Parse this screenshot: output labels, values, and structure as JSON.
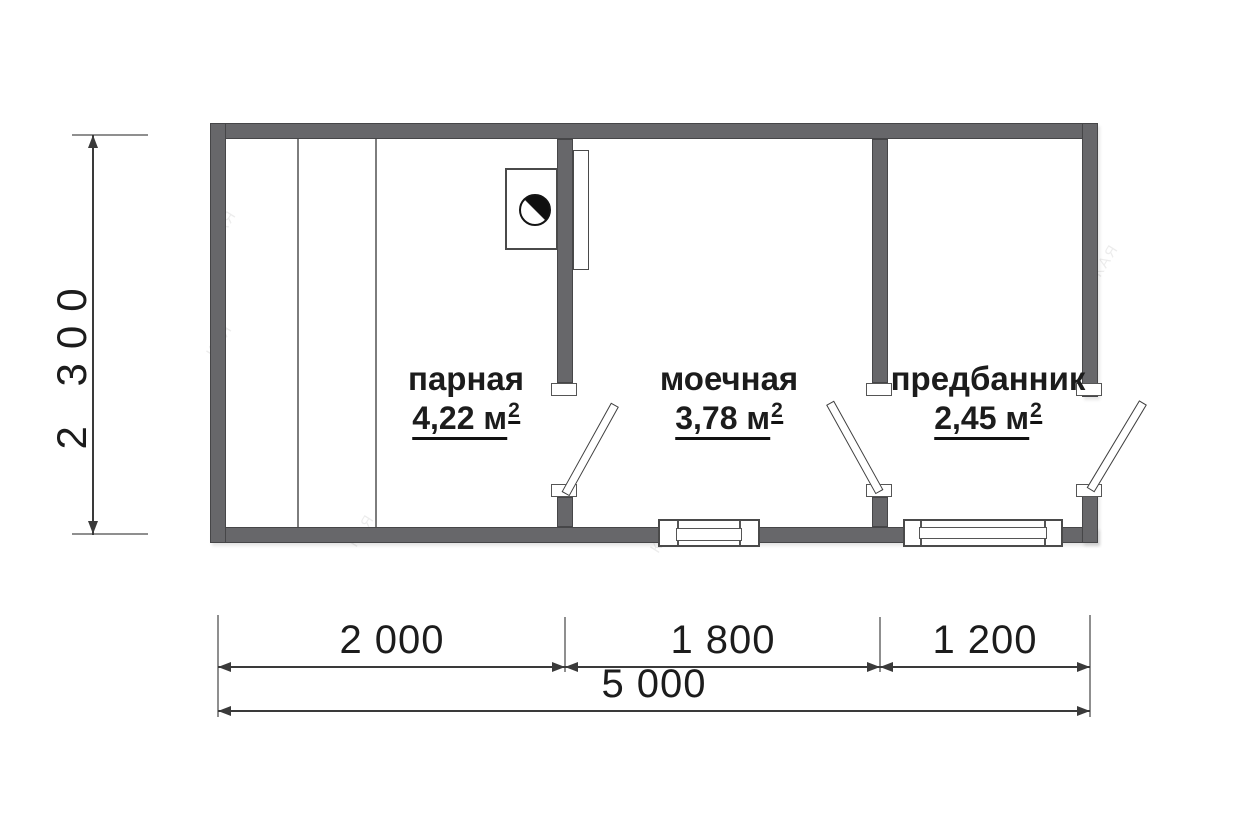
{
  "document": {
    "type": "floor-plan",
    "language": "ru"
  },
  "rooms": [
    {
      "name": "парная",
      "area": "4,22 м",
      "area_sup": "2"
    },
    {
      "name": "моечная",
      "area": "3,78 м",
      "area_sup": "2"
    },
    {
      "name": "предбанник",
      "area": "2,45 м",
      "area_sup": "2"
    }
  ],
  "dimensions": {
    "overall_height": "2 300",
    "overall_width": "5 000",
    "segments": [
      "2 000",
      "1 800",
      "1 200"
    ]
  },
  "watermark": {
    "text": "КАЯ"
  },
  "colors": {
    "wall": "#67676a",
    "line": "#3a3a3a",
    "extension": "#8f8f8f",
    "text": "#1c1c1c",
    "background": "#ffffff"
  }
}
